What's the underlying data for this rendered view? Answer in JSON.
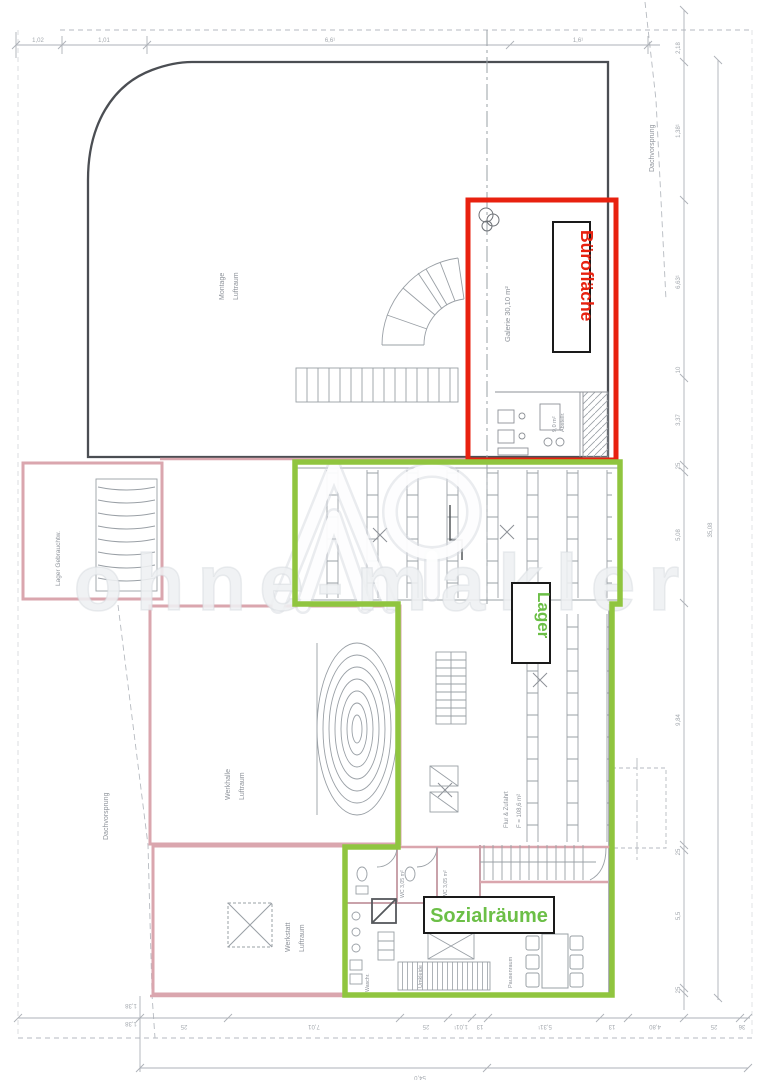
{
  "watermark": {
    "text": "ohne-makler"
  },
  "annotations": {
    "buero_label": "Bürofläche",
    "lager_label": "Lager",
    "sozial_label": "Sozialräume",
    "red_color": "#e8210f",
    "green_color": "#90c53f",
    "green_text_color": "#6cbf47"
  },
  "rooms": {
    "hall_line1": "Montage",
    "hall_line2": "Luftraum",
    "galerie": "Galerie 30,10 m²",
    "abstell_line1": "9,0 m²",
    "abstell_line2": "Abstellr.",
    "annex": "Lager Gebrauchtw.",
    "werkhalle_line1": "Werkhalle",
    "werkhalle_line2": "Luftraum",
    "werkstatt_line1": "Werkstatt",
    "werkstatt_line2": "Luftraum",
    "flur_line1": "Flur & Zufahrt",
    "flur_line2": "F = 108,6 m²",
    "wc1": "WC 3,05 m²",
    "wc2": "WC 3,05 m²",
    "umkleide": "Umkleide",
    "waschraum": "Waschr.",
    "pausenraum": "Pausenraum"
  },
  "site": {
    "overhang_left": "Dachvorsprung",
    "overhang_right": "Dachvorsprung"
  },
  "dims": {
    "top": [
      "1,02",
      "1,01",
      "6,6¹",
      "1,6¹"
    ],
    "right": [
      "2,18",
      "1,38¹",
      "6,63¹",
      "10",
      "3,37",
      "25",
      "5,08",
      "9,84",
      "25",
      "5,5",
      "25"
    ],
    "right_total": "35,08",
    "bottom": [
      "1,38",
      "1,38",
      "25",
      "7,01",
      "25",
      "1,01¹",
      "13",
      "5,31¹",
      "13",
      "4,80",
      "25",
      "36"
    ],
    "bottom_total": "54,0"
  }
}
